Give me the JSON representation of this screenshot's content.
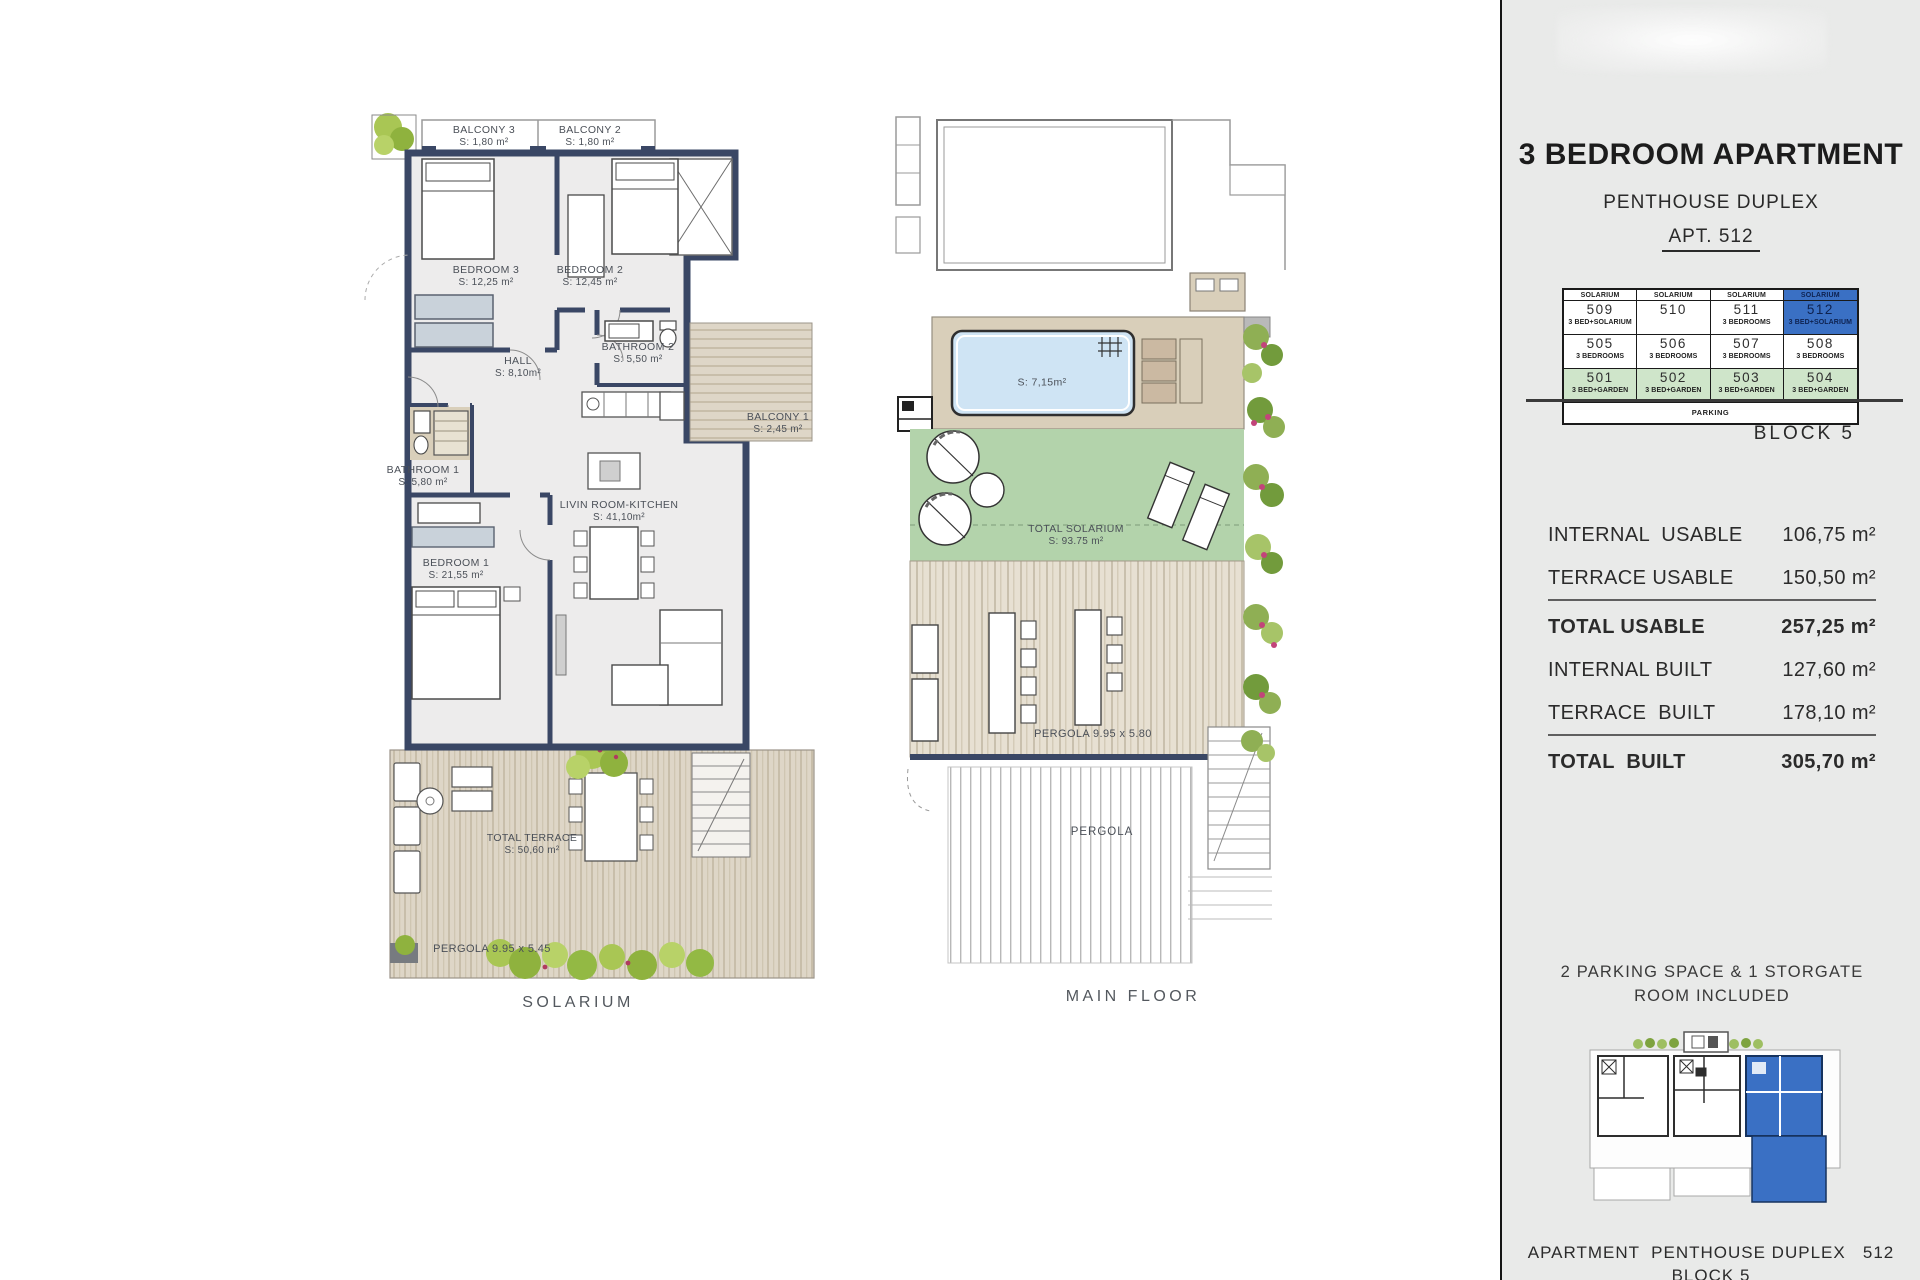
{
  "colors": {
    "accent_blue": "#3a70c4",
    "row_green": "#cfe5ca",
    "wall_navy": "#3a4765",
    "solarium_green": "#b3d3ab",
    "pool_blue": "#cfe4f4",
    "panel_bg": "#e9eae9"
  },
  "left_plan": {
    "floor_label": "SOLARIUM",
    "rooms": {
      "balcony3": {
        "name": "BALCONY 3",
        "area": "S: 1,80 m²"
      },
      "balcony2": {
        "name": "BALCONY 2",
        "area": "S: 1,80 m²"
      },
      "bedroom3": {
        "name": "BEDROOM 3",
        "area": "S: 12,25 m²"
      },
      "bedroom2": {
        "name": "BEDROOM 2",
        "area": "S: 12,45 m²"
      },
      "hall": {
        "name": "HALL",
        "area": "S: 8,10m²"
      },
      "bathroom2": {
        "name": "BATHROOM 2",
        "area": "S: 5,50 m²"
      },
      "balcony1": {
        "name": "BALCONY 1",
        "area": "S: 2,45 m²"
      },
      "bathroom1": {
        "name": "BATHROOM 1",
        "area": "S: 5,80 m²"
      },
      "living": {
        "name": "LIVIN ROOM-KITCHEN",
        "area": "S: 41,10m²"
      },
      "bedroom1": {
        "name": "BEDROOM 1",
        "area": "S: 21,55 m²"
      },
      "terrace": {
        "name": "TOTAL TERRACE",
        "area": "S: 50,60 m²"
      }
    },
    "pergola": "PERGOLA 9.95 x 5.45"
  },
  "main_plan": {
    "floor_label": "MAIN FLOOR",
    "pool_area": "S: 7,15m²",
    "solarium": {
      "name": "TOTAL SOLARIUM",
      "area": "S: 93.75 m²"
    },
    "pergola_dim": "PERGOLA 9.95 x 5.80",
    "pergola": "PERGOLA"
  },
  "panel": {
    "title": "3 BEDROOM APARTMENT",
    "subtitle": "PENTHOUSE DUPLEX",
    "apt_ref": "APT. 512",
    "block": "BLOCK 5",
    "table": {
      "col_headers": [
        "SOLARIUM",
        "SOLARIUM",
        "SOLARIUM",
        "SOLARIUM"
      ],
      "units": [
        {
          "num": "509",
          "type": "3 BED+SOLARIUM"
        },
        {
          "num": "510",
          "type": ""
        },
        {
          "num": "511",
          "type": "3 BEDROOMS"
        },
        {
          "num": "512",
          "type": "3 BED+SOLARIUM"
        },
        {
          "num": "505",
          "type": "3 BEDROOMS"
        },
        {
          "num": "506",
          "type": "3 BEDROOMS"
        },
        {
          "num": "507",
          "type": "3 BEDROOMS"
        },
        {
          "num": "508",
          "type": "3 BEDROOMS"
        },
        {
          "num": "501",
          "type": "3 BED+GARDEN"
        },
        {
          "num": "502",
          "type": "3 BED+GARDEN"
        },
        {
          "num": "503",
          "type": "3 BED+GARDEN"
        },
        {
          "num": "504",
          "type": "3 BED+GARDEN"
        }
      ],
      "footer": "PARKING"
    },
    "areas": [
      {
        "label": "INTERNAL  USABLE",
        "value": "106,75 m²"
      },
      {
        "label": "TERRACE USABLE",
        "value": "150,50 m²"
      },
      {
        "label": "TOTAL USABLE",
        "value": "257,25 m²"
      },
      {
        "label": "INTERNAL BUILT",
        "value": "127,60 m²"
      },
      {
        "label": "TERRACE  BUILT",
        "value": "178,10 m²"
      },
      {
        "label": "TOTAL  BUILT",
        "value": "305,70 m²"
      }
    ],
    "parking_line1": "2 PARKING SPACE & 1 STORGATE",
    "parking_line2": "ROOM INCLUDED",
    "footer_line1": "APARTMENT  PENTHOUSE DUPLEX   512",
    "footer_line2": "BLOCK 5"
  }
}
